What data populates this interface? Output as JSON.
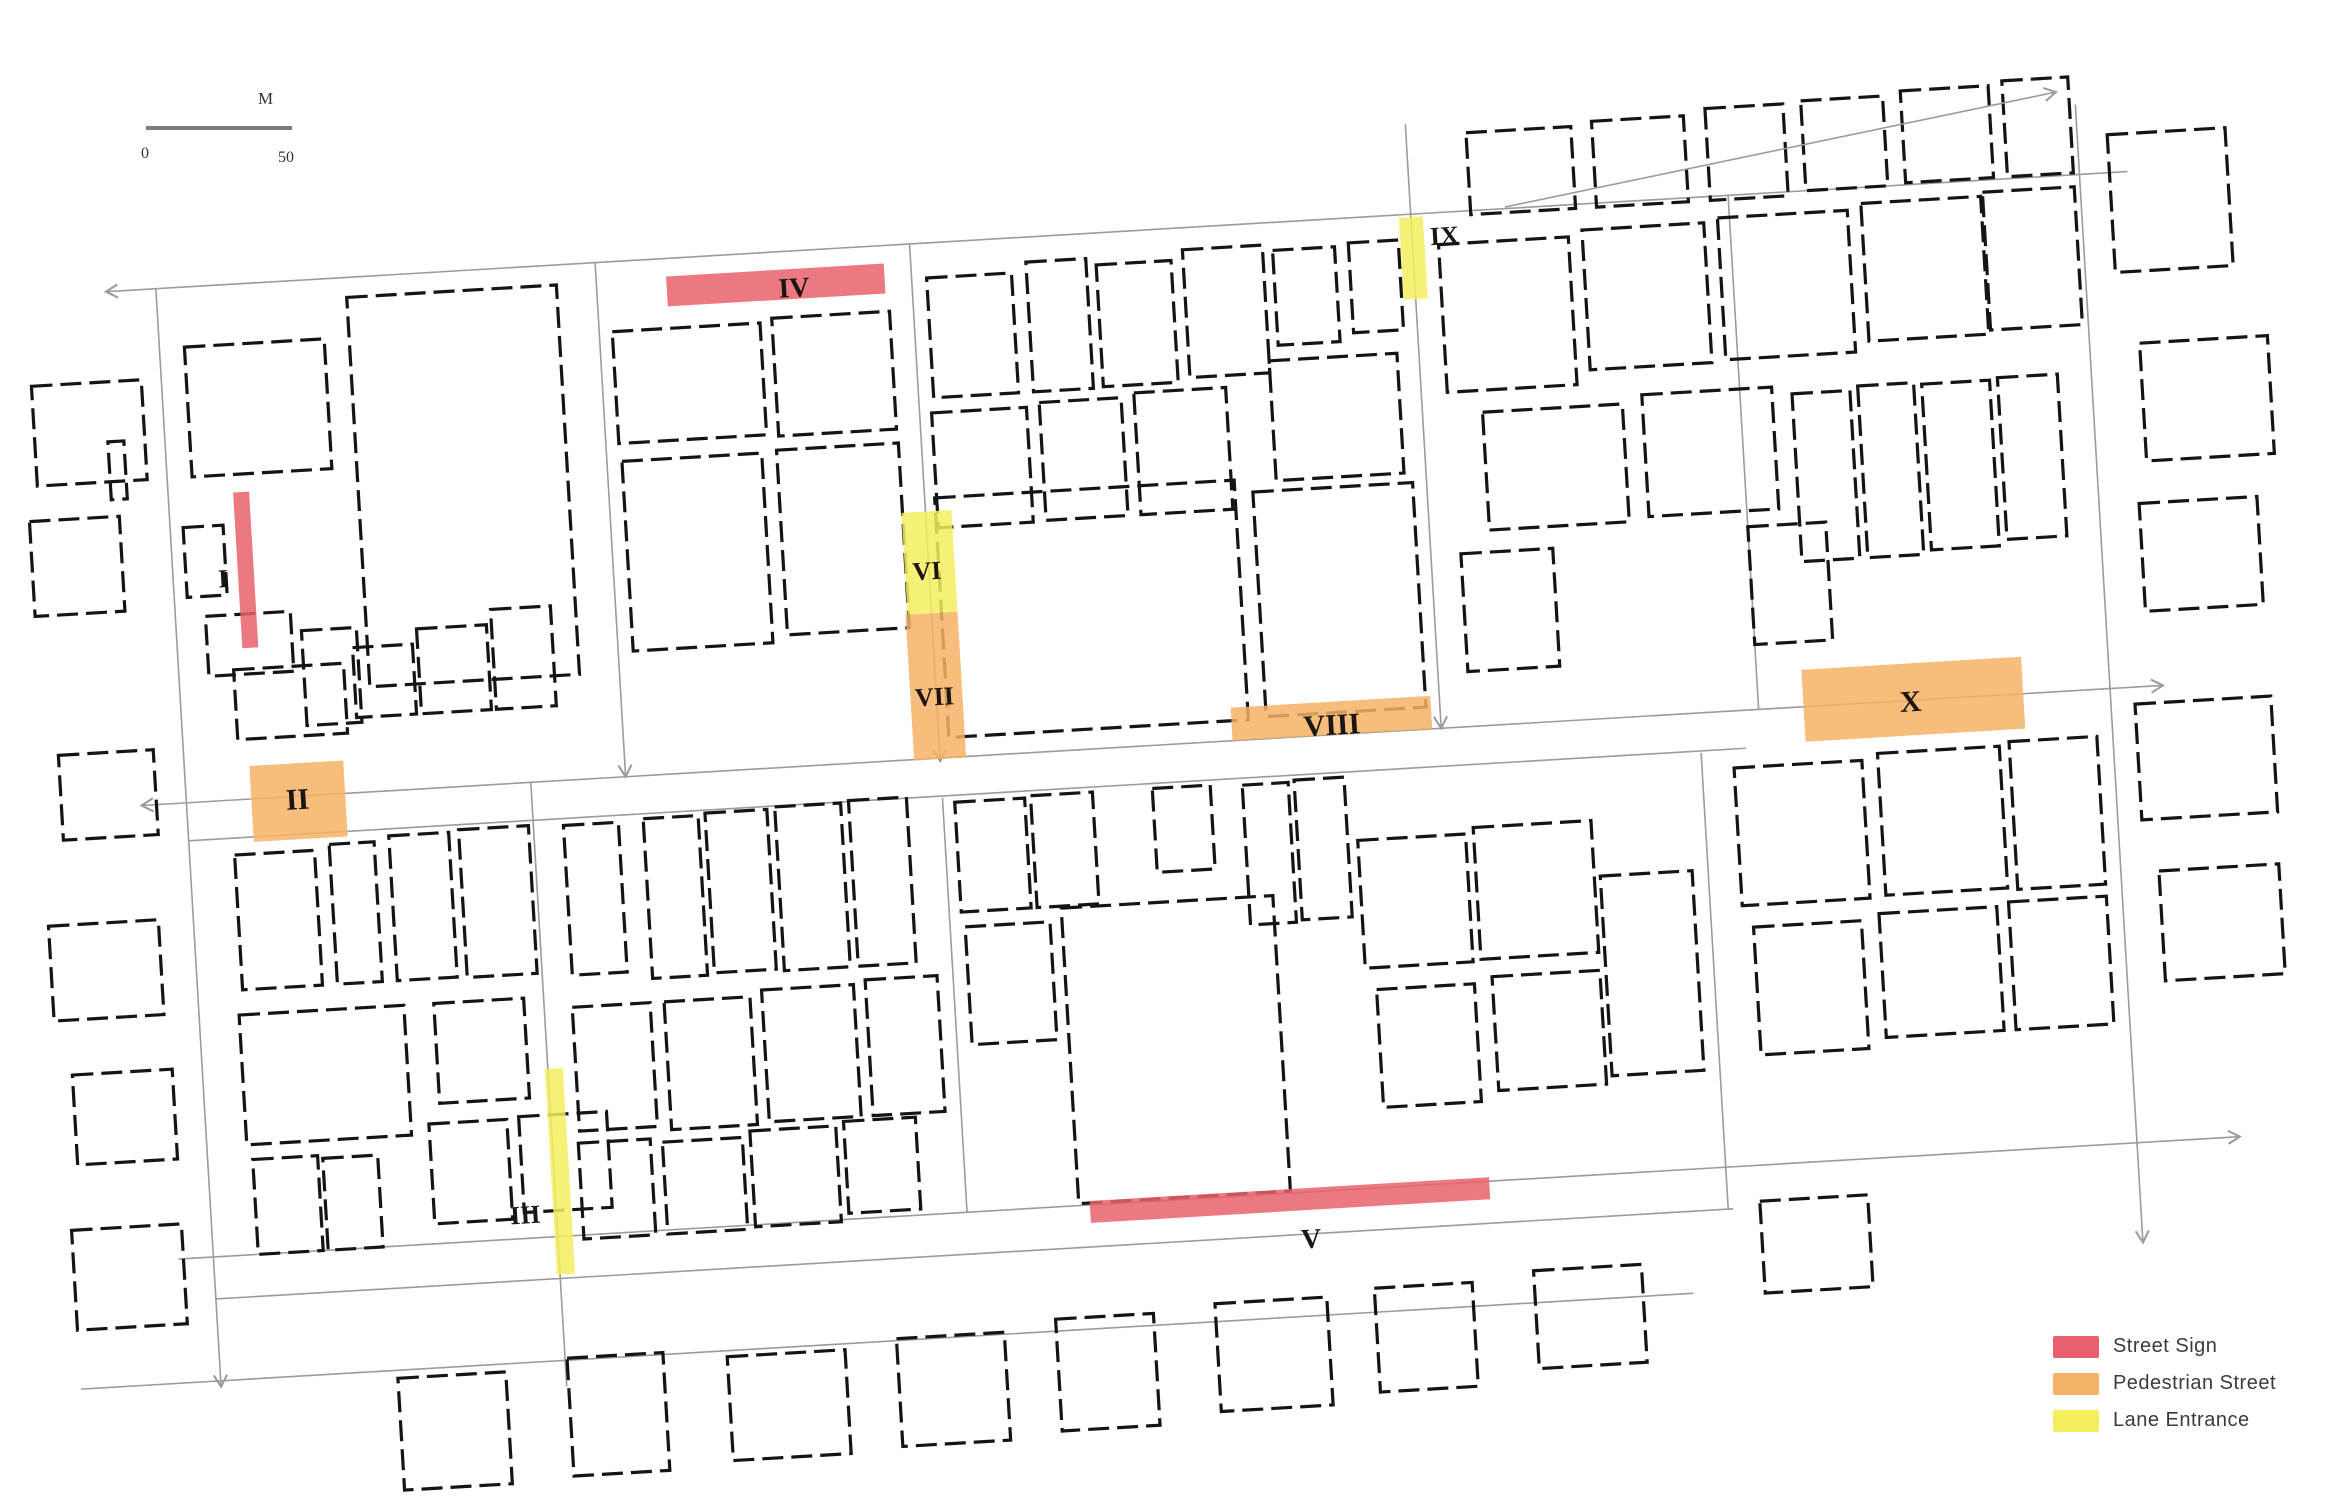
{
  "figure": {
    "kind": "building footprint map with surveyed street segments",
    "background": "#ffffff"
  },
  "colors": {
    "building_stroke": "#141414",
    "street_line": "#9b9b9b",
    "scale_bar": "#7d7d7d"
  },
  "scale_bar": {
    "left_label": "0",
    "right_label": "50",
    "unit_label": "M"
  },
  "legend": {
    "items": [
      {
        "type": "street-sign",
        "label": "Street Sign",
        "color": "#e9606c"
      },
      {
        "type": "pedestrian-street",
        "label": "Pedestrian Street",
        "color": "#f4b266"
      },
      {
        "type": "lane-entrance",
        "label": "Lane Entrance",
        "color": "#f5ee5e"
      }
    ]
  },
  "map": {
    "rotation_deg": -3.4,
    "rotation_center": [
      1160,
      750
    ],
    "streets": [
      {
        "x1": 135,
        "y1": 230,
        "x2": 2160,
        "y2": 230,
        "arrow_start": true,
        "arrow_end": false
      },
      {
        "x1": 140,
        "y1": 745,
        "x2": 2165,
        "y2": 745,
        "arrow_start": true,
        "arrow_end": true
      },
      {
        "x1": 185,
        "y1": 783,
        "x2": 1745,
        "y2": 783,
        "arrow_start": false,
        "arrow_end": false
      },
      {
        "x1": 150,
        "y1": 1200,
        "x2": 2215,
        "y2": 1200,
        "arrow_start": false,
        "arrow_end": true
      },
      {
        "x1": 185,
        "y1": 1242,
        "x2": 1705,
        "y2": 1242,
        "arrow_start": false,
        "arrow_end": false
      },
      {
        "x1": 45,
        "y1": 1324,
        "x2": 1660,
        "y2": 1324,
        "arrow_start": false,
        "arrow_end": false
      },
      {
        "x1": 185,
        "y1": 230,
        "x2": 185,
        "y2": 1330,
        "arrow_start": false,
        "arrow_end": true
      },
      {
        "x1": 625,
        "y1": 230,
        "x2": 625,
        "y2": 745,
        "arrow_start": false,
        "arrow_end": true
      },
      {
        "x1": 530,
        "y1": 745,
        "x2": 530,
        "y2": 1350,
        "arrow_start": false,
        "arrow_end": false
      },
      {
        "x1": 940,
        "y1": 230,
        "x2": 940,
        "y2": 748,
        "arrow_start": false,
        "arrow_end": true
      },
      {
        "x1": 940,
        "y1": 785,
        "x2": 940,
        "y2": 1200,
        "arrow_start": false,
        "arrow_end": false
      },
      {
        "x1": 1442,
        "y1": 140,
        "x2": 1442,
        "y2": 745,
        "arrow_start": false,
        "arrow_end": true
      },
      {
        "x1": 1760,
        "y1": 230,
        "x2": 1760,
        "y2": 745,
        "arrow_start": false,
        "arrow_end": false
      },
      {
        "x1": 1700,
        "y1": 785,
        "x2": 1700,
        "y2": 1242,
        "arrow_start": false,
        "arrow_end": false
      },
      {
        "x1": 2112,
        "y1": 160,
        "x2": 2112,
        "y2": 1300,
        "arrow_start": false,
        "arrow_end": true
      }
    ],
    "overlay_streets": [
      {
        "x1": 1505,
        "y1": 207,
        "x2": 2056,
        "y2": 92,
        "arrow_start": false,
        "arrow_end": true
      }
    ],
    "buildings": [
      [
        55,
        320,
        110,
        100
      ],
      [
        45,
        455,
        90,
        95
      ],
      [
        128,
        380,
        16,
        58
      ],
      [
        60,
        690,
        95,
        85
      ],
      [
        40,
        860,
        110,
        95
      ],
      [
        55,
        1010,
        100,
        90
      ],
      [
        45,
        1165,
        110,
        100
      ],
      [
        210,
        290,
        140,
        130
      ],
      [
        375,
        250,
        210,
        390
      ],
      [
        198,
        470,
        40,
        70
      ],
      [
        215,
        560,
        85,
        60
      ],
      [
        240,
        615,
        110,
        70
      ],
      [
        310,
        580,
        55,
        95
      ],
      [
        360,
        600,
        60,
        70
      ],
      [
        425,
        585,
        70,
        85
      ],
      [
        500,
        570,
        60,
        100
      ],
      [
        638,
        300,
        148,
        112
      ],
      [
        798,
        296,
        118,
        118
      ],
      [
        640,
        430,
        140,
        190
      ],
      [
        795,
        428,
        122,
        185
      ],
      [
        955,
        265,
        85,
        120
      ],
      [
        1055,
        255,
        60,
        130
      ],
      [
        1125,
        262,
        75,
        122
      ],
      [
        1212,
        252,
        80,
        128
      ],
      [
        1302,
        258,
        62,
        95
      ],
      [
        1378,
        255,
        50,
        90
      ],
      [
        952,
        400,
        95,
        115
      ],
      [
        1060,
        396,
        82,
        118
      ],
      [
        1155,
        392,
        92,
        122
      ],
      [
        1292,
        368,
        128,
        120
      ],
      [
        950,
        485,
        300,
        240
      ],
      [
        1268,
        498,
        160,
        225
      ],
      [
        1502,
        152,
        105,
        82
      ],
      [
        1628,
        148,
        92,
        86
      ],
      [
        1742,
        142,
        78,
        92
      ],
      [
        1838,
        140,
        82,
        90
      ],
      [
        1938,
        136,
        88,
        92
      ],
      [
        2040,
        132,
        66,
        96
      ],
      [
        1468,
        262,
        130,
        148
      ],
      [
        1612,
        256,
        122,
        140
      ],
      [
        1748,
        252,
        130,
        142
      ],
      [
        1892,
        246,
        120,
        138
      ],
      [
        2014,
        242,
        92,
        138
      ],
      [
        1502,
        432,
        140,
        118
      ],
      [
        1662,
        424,
        130,
        122
      ],
      [
        1812,
        432,
        58,
        168
      ],
      [
        1878,
        428,
        56,
        172
      ],
      [
        1942,
        430,
        68,
        166
      ],
      [
        2018,
        428,
        60,
        162
      ],
      [
        1760,
        562,
        78,
        118
      ],
      [
        1472,
        572,
        92,
        118
      ],
      [
        230,
        800,
        80,
        135
      ],
      [
        325,
        795,
        45,
        140
      ],
      [
        385,
        790,
        60,
        145
      ],
      [
        455,
        788,
        70,
        148
      ],
      [
        225,
        960,
        165,
        130
      ],
      [
        420,
        960,
        90,
        100
      ],
      [
        408,
        1080,
        78,
        100
      ],
      [
        498,
        1078,
        88,
        96
      ],
      [
        230,
        1105,
        65,
        95
      ],
      [
        300,
        1108,
        55,
        92
      ],
      [
        560,
        790,
        55,
        150
      ],
      [
        640,
        788,
        55,
        160
      ],
      [
        702,
        786,
        62,
        160
      ],
      [
        772,
        784,
        66,
        164
      ],
      [
        846,
        782,
        58,
        166
      ],
      [
        558,
        972,
        78,
        124
      ],
      [
        650,
        972,
        86,
        128
      ],
      [
        748,
        966,
        92,
        132
      ],
      [
        852,
        962,
        72,
        136
      ],
      [
        556,
        1108,
        72,
        96
      ],
      [
        640,
        1112,
        80,
        92
      ],
      [
        728,
        1106,
        86,
        96
      ],
      [
        822,
        1102,
        72,
        92
      ],
      [
        952,
        790,
        70,
        110
      ],
      [
        1028,
        788,
        62,
        112
      ],
      [
        1150,
        788,
        58,
        84
      ],
      [
        1240,
        790,
        46,
        140
      ],
      [
        1292,
        788,
        50,
        140
      ],
      [
        955,
        915,
        85,
        118
      ],
      [
        1052,
        902,
        212,
        296
      ],
      [
        1352,
        852,
        108,
        128
      ],
      [
        1468,
        846,
        118,
        132
      ],
      [
        1362,
        1002,
        98,
        118
      ],
      [
        1478,
        996,
        108,
        114
      ],
      [
        1592,
        902,
        92,
        200
      ],
      [
        1732,
        802,
        128,
        138
      ],
      [
        1876,
        796,
        122,
        142
      ],
      [
        2008,
        792,
        88,
        148
      ],
      [
        1742,
        962,
        108,
        128
      ],
      [
        1868,
        956,
        118,
        124
      ],
      [
        1998,
        952,
        98,
        128
      ],
      [
        362,
        1332,
        108,
        112
      ],
      [
        532,
        1322,
        96,
        118
      ],
      [
        692,
        1330,
        118,
        104
      ],
      [
        862,
        1322,
        108,
        108
      ],
      [
        1022,
        1312,
        98,
        112
      ],
      [
        1182,
        1306,
        112,
        108
      ],
      [
        1342,
        1300,
        98,
        104
      ],
      [
        1502,
        1292,
        108,
        98
      ],
      [
        1732,
        1236,
        108,
        92
      ],
      [
        2142,
        192,
        118,
        138
      ],
      [
        2162,
        402,
        128,
        118
      ],
      [
        2152,
        562,
        118,
        108
      ],
      [
        2136,
        762,
        136,
        116
      ],
      [
        2150,
        930,
        120,
        110
      ]
    ],
    "zones": [
      {
        "id": "I",
        "type": "street-sign",
        "rect": [
          250,
          438,
          16,
          156
        ],
        "label_pos": [
          240,
          532
        ],
        "anchor": "end",
        "font": 26
      },
      {
        "id": "II",
        "type": "pedestrian-street",
        "rect": [
          250,
          712,
          94,
          76
        ],
        "label_pos": [
          296,
          758
        ],
        "anchor": "middle",
        "font": 30
      },
      {
        "id": "III",
        "type": "lane-entrance",
        "rect": [
          527,
          1032,
          18,
          206
        ],
        "label_pos": [
          514,
          1185
        ],
        "anchor": "end",
        "font": 26
      },
      {
        "id": "IV",
        "type": "street-sign",
        "rect": [
          695,
          248,
          218,
          30
        ],
        "label_pos": [
          822,
          276
        ],
        "anchor": "middle",
        "font": 28
      },
      {
        "id": "V",
        "type": "street-sign",
        "rect": [
          1063,
          1196,
          400,
          22
        ],
        "label_pos": [
          1282,
          1256
        ],
        "anchor": "middle",
        "font": 28
      },
      {
        "id": "VI",
        "type": "lane-entrance",
        "rect": [
          916,
          498,
          50,
          102
        ],
        "label_pos": [
          938,
          566
        ],
        "anchor": "middle",
        "font": 26
      },
      {
        "id": "VII",
        "type": "pedestrian-street",
        "rect": [
          914,
          600,
          52,
          146
        ],
        "label_pos": [
          938,
          692
        ],
        "anchor": "middle",
        "font": 26
      },
      {
        "id": "VIII",
        "type": "pedestrian-street",
        "rect": [
          1233,
          712,
          200,
          33
        ],
        "label_pos": [
          1333,
          745
        ],
        "anchor": "middle",
        "font": 30
      },
      {
        "id": "IX",
        "type": "lane-entrance",
        "rect": [
          1430,
          233,
          24,
          82
        ],
        "label_pos": [
          1460,
          262
        ],
        "anchor": "start",
        "font": 26
      },
      {
        "id": "X",
        "type": "pedestrian-street",
        "rect": [
          1805,
          708,
          220,
          72
        ],
        "label_pos": [
          1912,
          756
        ],
        "anchor": "middle",
        "font": 30
      }
    ]
  }
}
